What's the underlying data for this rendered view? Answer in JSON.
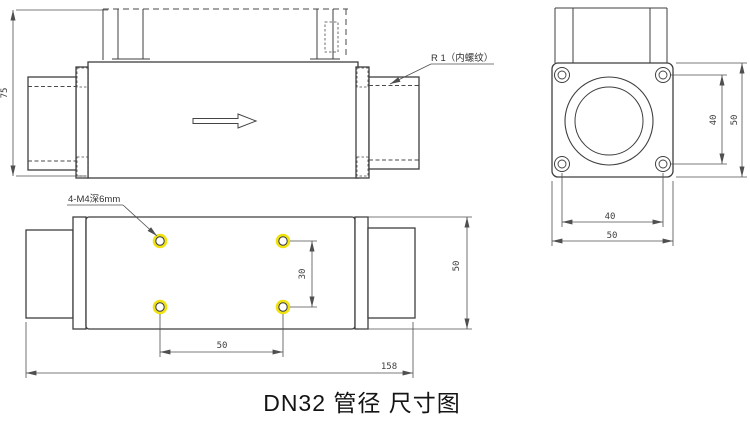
{
  "title": "DN32 管径 尺寸图",
  "colors": {
    "line": "#3f3f3f",
    "dim": "#4f4f4f",
    "highlight": "#efe20e"
  },
  "side_view": {
    "height": "75",
    "thread_label": "R 1（内螺纹）"
  },
  "end_view": {
    "bolt_spacing_v": "40",
    "flange_height": "50",
    "bolt_spacing_h": "40",
    "flange_width": "50"
  },
  "plan_view": {
    "hole_label": "4-M4深6mm",
    "hole_spacing_v": "30",
    "hole_spacing_h": "50",
    "total_length": "158",
    "body_width": "50"
  }
}
